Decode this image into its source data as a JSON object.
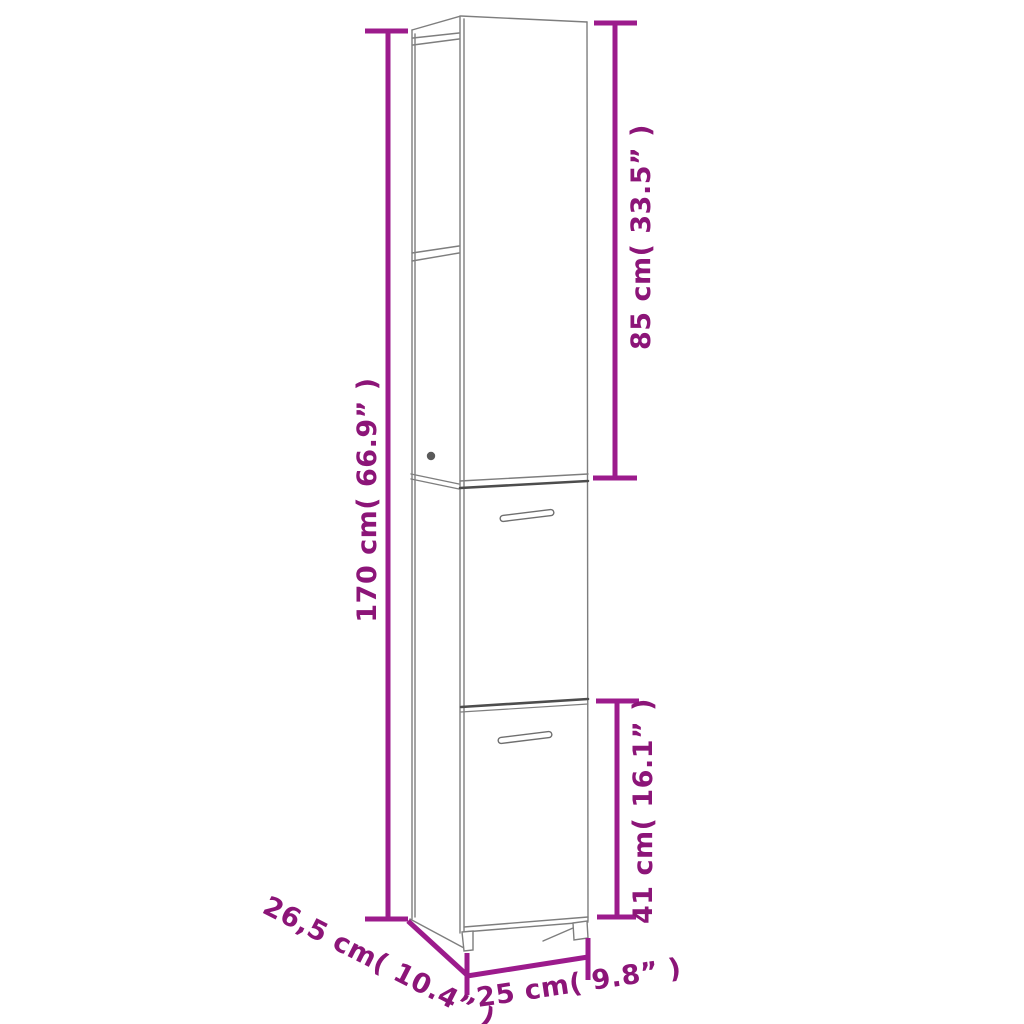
{
  "diagram": {
    "type": "furniture-dimension-diagram",
    "subject": "tall narrow bathroom cabinet, open top shelf compartment and two lower doors, line drawing in perspective",
    "labels": {
      "total_height": "170 cm( 66.9” )",
      "upper_height": "85 cm( 33.5” )",
      "lower_height": "41 cm( 16.1” )",
      "depth": "26,5 cm( 10.4” )",
      "width": "25 cm( 9.8” )"
    },
    "values": {
      "total_height_cm": "170",
      "total_height_in": "66.9",
      "upper_height_cm": "85",
      "upper_height_in": "33.5",
      "lower_height_cm": "41",
      "lower_height_in": "16.1",
      "depth_cm": "26,5",
      "depth_in": "10.4",
      "width_cm": "25",
      "width_in": "9.8"
    },
    "colors": {
      "dimension_line": "#9C1B8C",
      "dimension_text": "#8C1578",
      "cabinet_outline": "#7e7e7e",
      "door_gap": "#4d4d4d",
      "background": "#ffffff"
    }
  }
}
